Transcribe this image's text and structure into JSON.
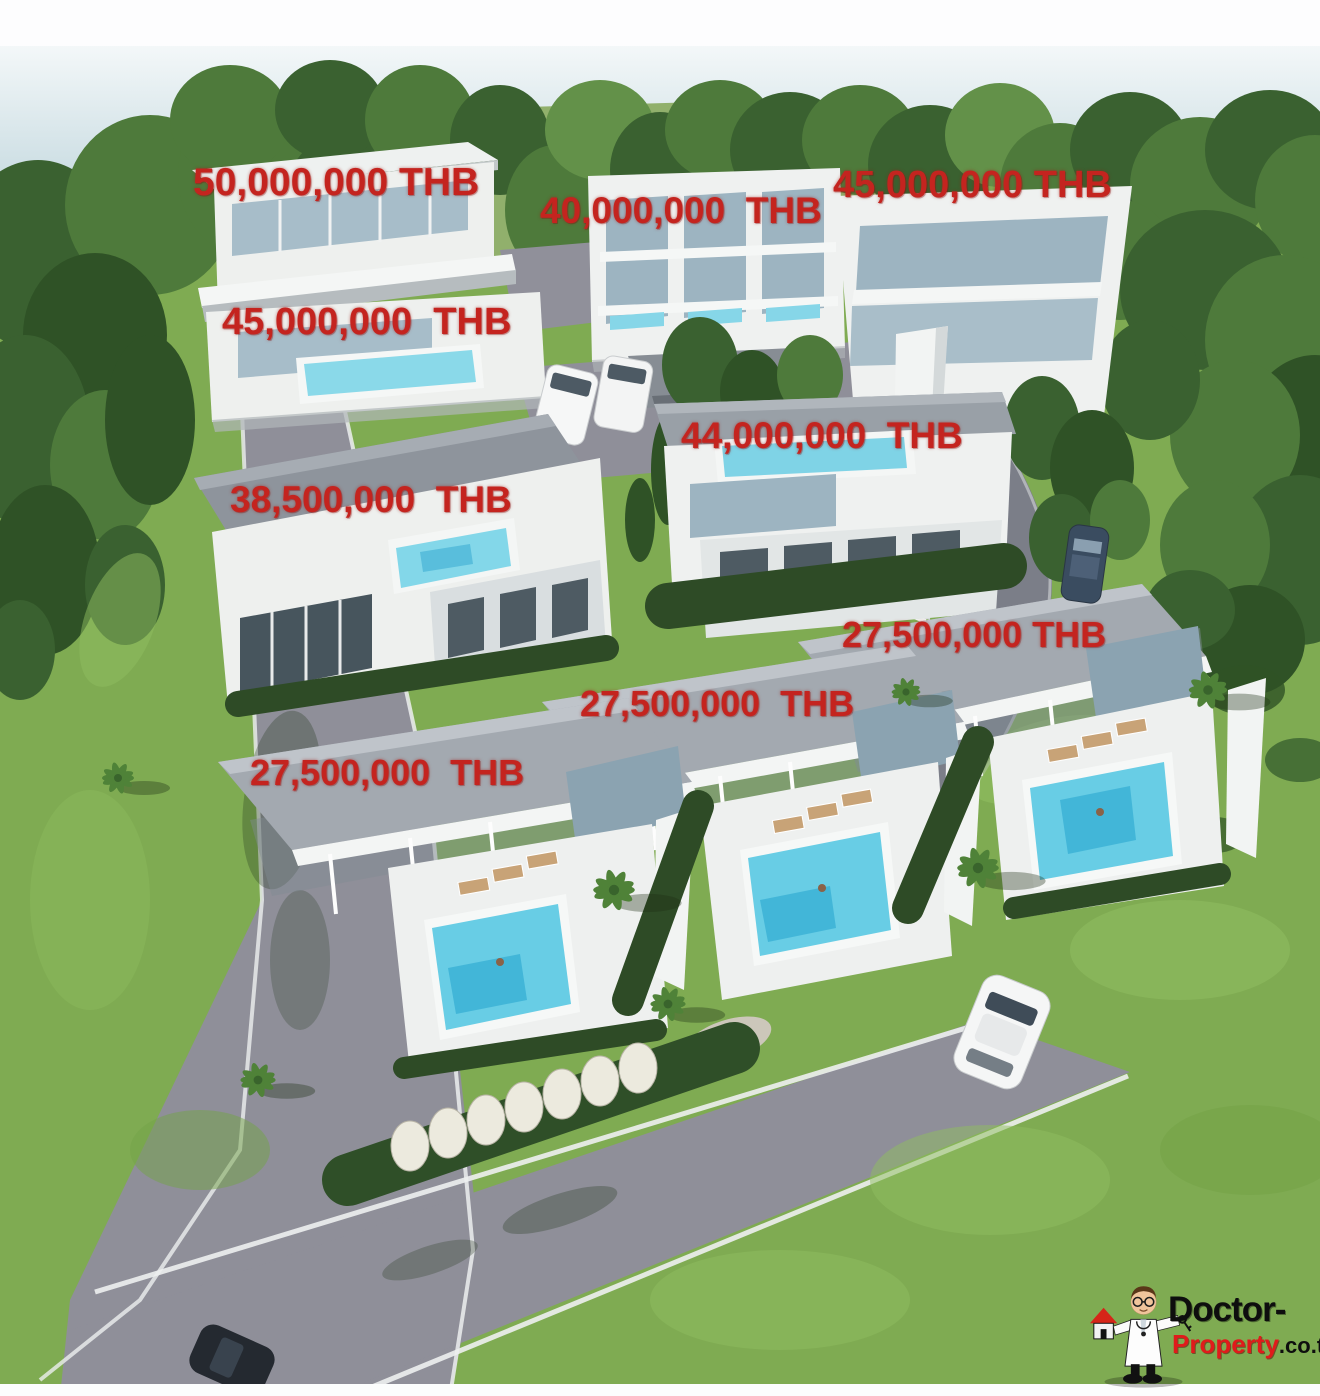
{
  "scene_title": "Villa development aerial rendering with sale prices",
  "currency": "THB",
  "price_labels": [
    {
      "id": "villa-top-left",
      "text": "50,000,000 THB"
    },
    {
      "id": "villa-top-middle",
      "text": "40,000,000  THB"
    },
    {
      "id": "villa-top-right",
      "text": "45,000,000 THB"
    },
    {
      "id": "villa-upper-left",
      "text": "45,000,000  THB"
    },
    {
      "id": "villa-middle-right",
      "text": "44,000,000  THB"
    },
    {
      "id": "villa-middle-left",
      "text": "38,500,000  THB"
    },
    {
      "id": "villa-bottom-right",
      "text": "27,500,000 THB"
    },
    {
      "id": "villa-bottom-middle",
      "text": "27,500,000  THB"
    },
    {
      "id": "villa-bottom-left",
      "text": "27,500,000  THB"
    }
  ],
  "watermark": {
    "brand_top": "Doctor-",
    "brand_bottom_red": "Property",
    "brand_bottom_suffix": ".co.th"
  },
  "colors": {
    "price_text": "#c4241f",
    "logo_red": "#e01b1b",
    "logo_black": "#0e0e0e",
    "road": "#8f8f99",
    "grass": "#7fab52",
    "tree_dark": "#3a6130",
    "pool": "#68cde5",
    "building_white": "#eff1f0"
  }
}
